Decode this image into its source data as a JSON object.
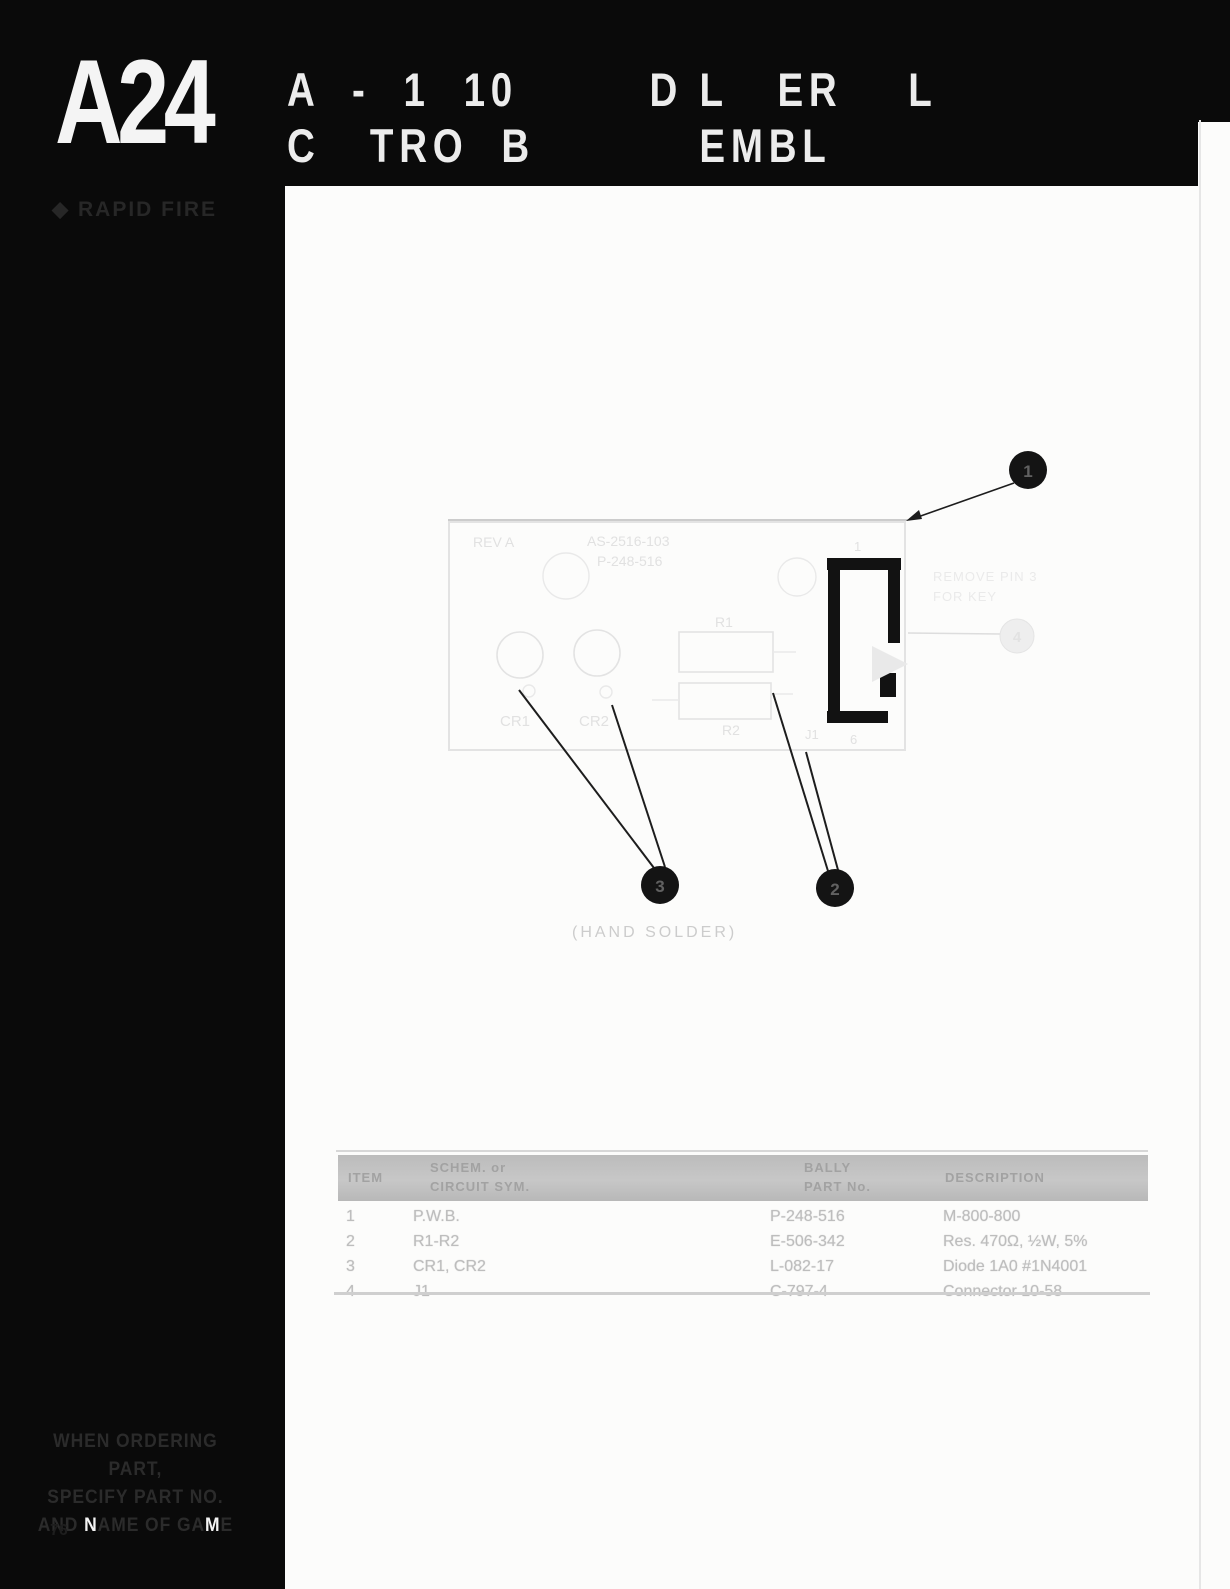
{
  "header": {
    "section_code": "A24",
    "title_line1": "A  -  1  10        D L   ER    L",
    "title_line2": "C   TRO  B          EMBL"
  },
  "sidebar": {
    "game_label": "◆ RAPID FIRE",
    "ordering_note": {
      "line1": "WHEN ORDERING PART,",
      "line2": "SPECIFY PART NO.",
      "line3a": "AND ",
      "line3b": "N",
      "line3c": "AME OF GA",
      "line3d": "M",
      "line3e": "E"
    },
    "page_number": "76"
  },
  "diagram": {
    "board": {
      "rev": "REV A",
      "assy_no": "AS-2516-103",
      "pwb_no": "P-248-516",
      "labels": {
        "cr1": "CR1",
        "cr2": "CR2",
        "r1": "R1",
        "r2": "R2",
        "j1": "J1",
        "pin_top": "1",
        "pin_bottom": "6"
      }
    },
    "callouts": {
      "c1": "1",
      "c2": "2",
      "c3": "3",
      "c4": "4"
    },
    "notes": {
      "connector_note_line1": "REMOVE PIN 3",
      "connector_note_line2": "FOR KEY",
      "hand_solder": "(HAND SOLDER)"
    }
  },
  "parts_table": {
    "headers": {
      "item": "ITEM",
      "circuit_line1": "SCHEM. or",
      "circuit_line2": "CIRCUIT SYM.",
      "part_line1": "BALLY",
      "part_line2": "PART No.",
      "description": "DESCRIPTION"
    },
    "rows": [
      {
        "item": "1",
        "circuit": "P.W.B.",
        "part": "P-248-516",
        "description": "M-800-800"
      },
      {
        "item": "2",
        "circuit": "R1-R2",
        "part": "E-506-342",
        "description": "Res. 470Ω, ½W, 5%"
      },
      {
        "item": "3",
        "circuit": "CR1, CR2",
        "part": "L-082-17",
        "description": "Diode 1A0 #1N4001"
      },
      {
        "item": "4",
        "circuit": "J1",
        "part": "C-797-4",
        "description": "Connector 10-58"
      }
    ]
  }
}
